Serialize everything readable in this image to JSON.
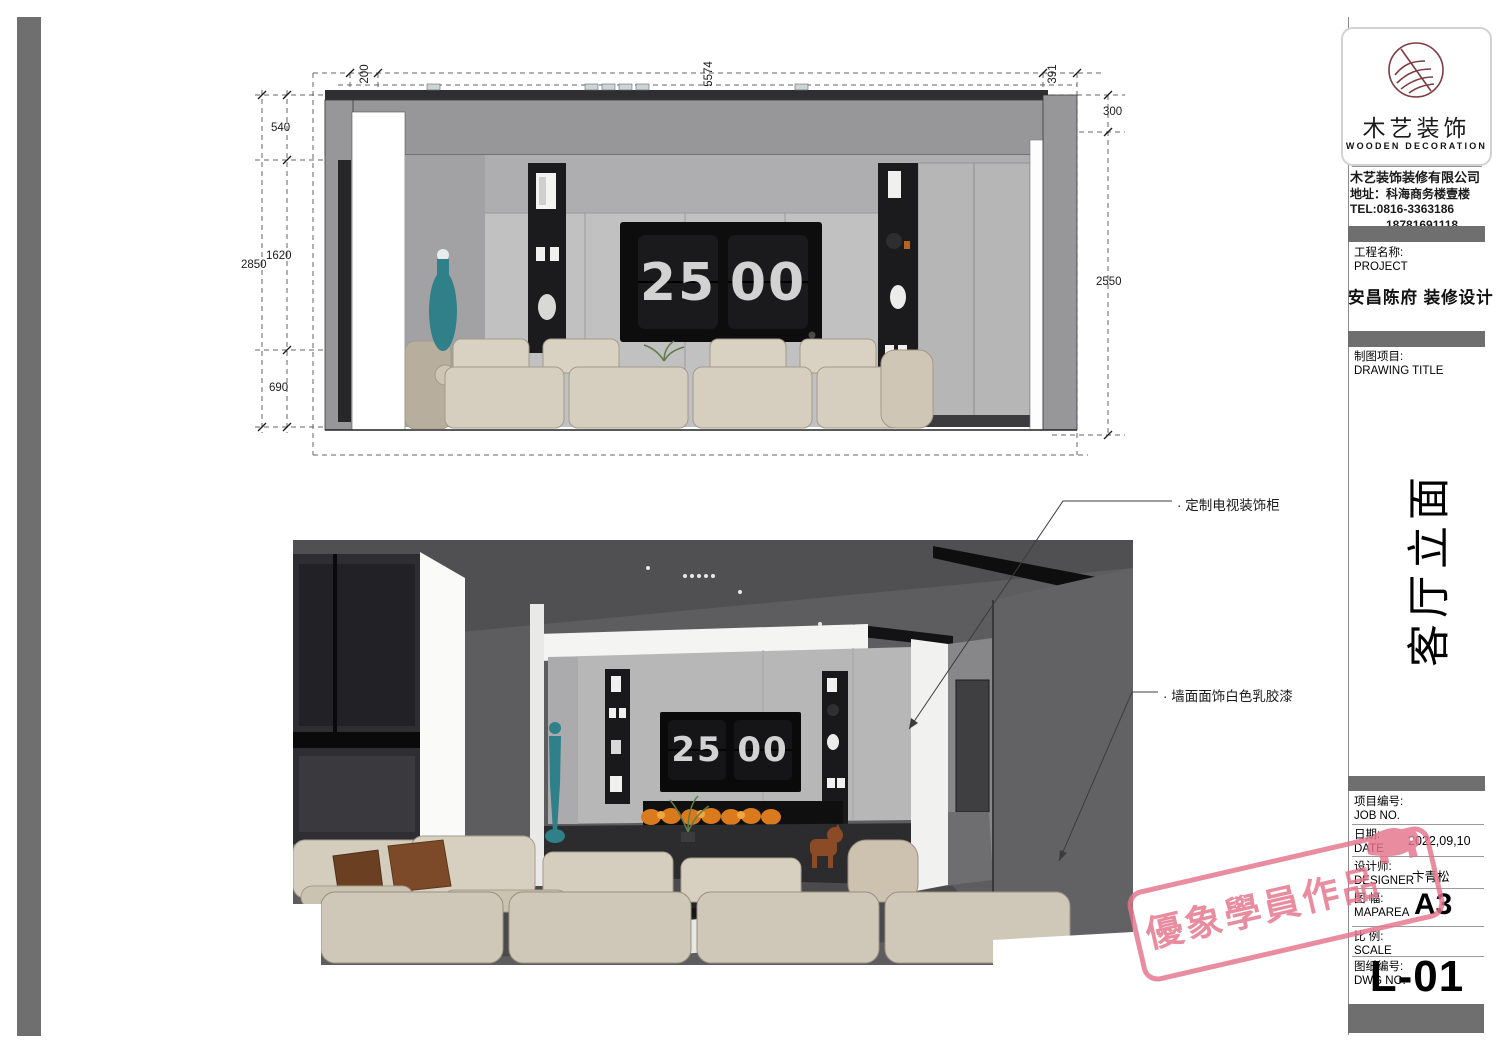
{
  "brand": {
    "cn": "木艺装饰",
    "en": "WOODEN DECORATION",
    "company": "木艺装饰装修有限公司",
    "address": "地址：科海商务楼壹楼",
    "tel": "TEL:0816-3363186",
    "tel2": "18781691118"
  },
  "title_block": {
    "project_label_cn": "工程名称:",
    "project_label_en": "PROJECT",
    "project_name": "安昌陈府 装修设计",
    "drawing_label_cn": "制图项目:",
    "drawing_label_en": "DRAWING TITLE",
    "drawing_title": "客厅立面",
    "fields": [
      {
        "cn": "项目编号:",
        "en": "JOB NO.",
        "value": ""
      },
      {
        "cn": "日期:",
        "en": "DATE",
        "value": "2022,09,10"
      },
      {
        "cn": "设计师:",
        "en": "DESIGNER",
        "value": "卞青松"
      },
      {
        "cn": "图 幅:",
        "en": "MAPAREA",
        "value": "A3"
      },
      {
        "cn": "比 例:",
        "en": "SCALE",
        "value": ""
      },
      {
        "cn": "图纸编号:",
        "en": "DWG NO.",
        "value": ""
      }
    ],
    "sheet_no": "L-01"
  },
  "watermark": {
    "text": "優象學員作品"
  },
  "elevation": {
    "dims": {
      "top_offset": "200",
      "top_width": "5574",
      "top_right": "391",
      "left_total": "2850",
      "left_seg1": "540",
      "left_seg2": "1620",
      "left_seg3": "690",
      "right_drop": "300",
      "right_height": "2550"
    },
    "clock": {
      "h": "25",
      "m": "00"
    }
  },
  "perspective": {
    "clock": {
      "h": "25",
      "m": "00"
    }
  },
  "annotations": {
    "tv_cabinet": "· 定制电视装饰柜",
    "wall_paint": "· 墙面面饰白色乳胶漆"
  },
  "colors": {
    "watermark_pink": "#e5748b",
    "bar_gray": "#6f6f6f",
    "logo_maroon": "#7f3b42",
    "teal_accent": "#2f8089",
    "flame_orange": "#d97a1c"
  }
}
